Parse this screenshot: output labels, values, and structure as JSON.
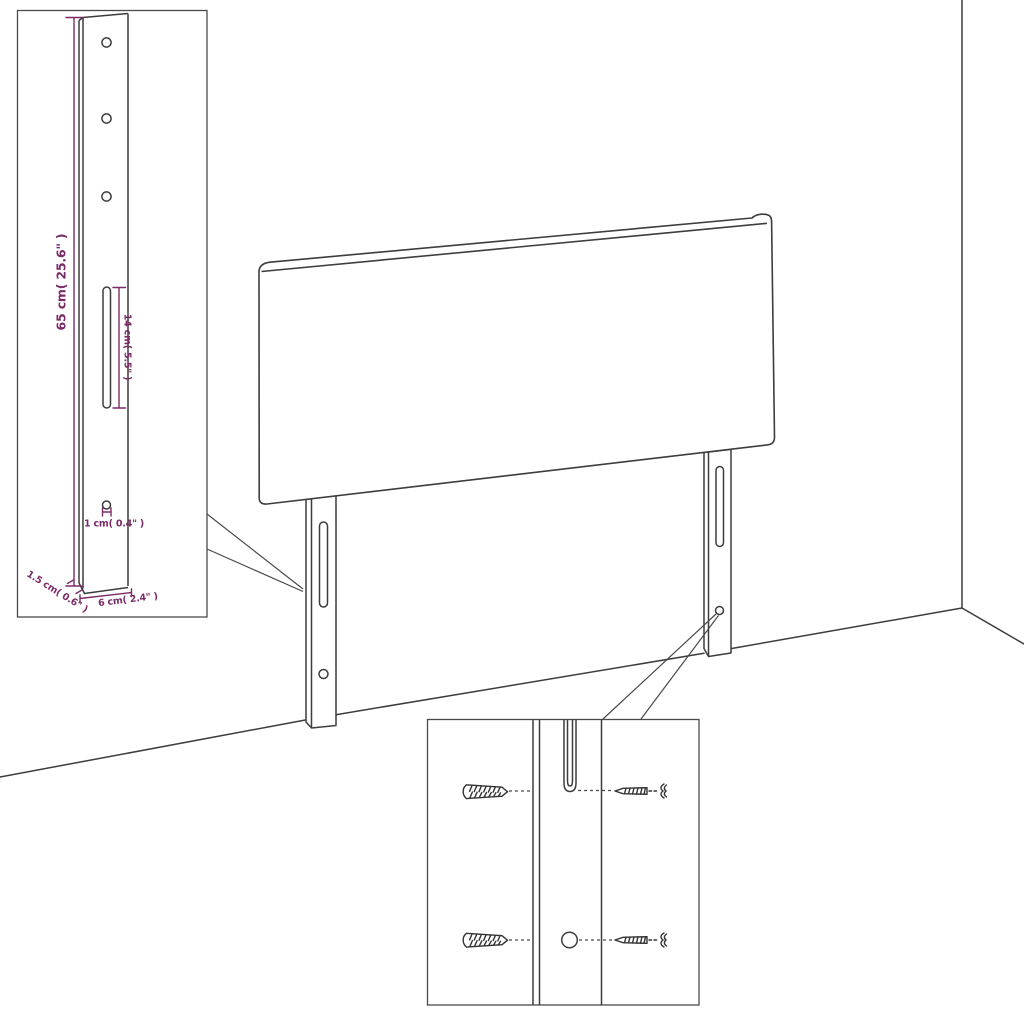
{
  "detail_inset": {
    "dimensions": {
      "height": "65 cm( 25.6\" )",
      "slot_length": "14 cm( 5.5\" )",
      "hole_diameter": "1 cm( 0.4\" )",
      "depth": "1.5 cm( 0.6\" )",
      "width": "6 cm( 2.4\" )"
    }
  },
  "colors": {
    "dimension_accent": "#7b2a68",
    "line": "#3d3d3d"
  }
}
